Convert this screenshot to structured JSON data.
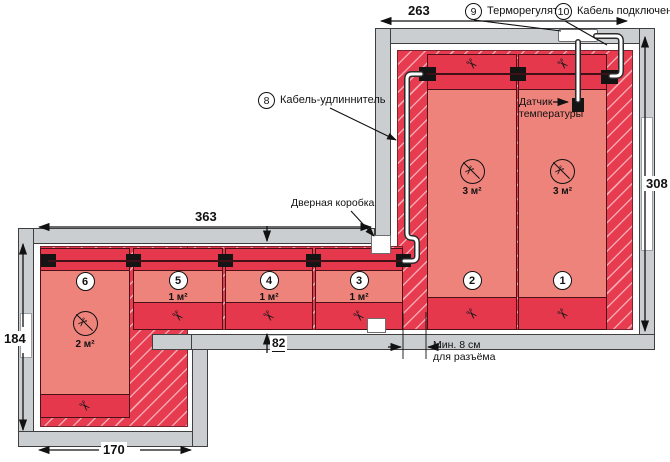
{
  "legend": {
    "thermostat": {
      "num": "9",
      "label": "Терморегулятор"
    },
    "connection_cable": {
      "num": "10",
      "label": "Кабель подключения"
    },
    "extension_cable": {
      "num": "8",
      "label": "Кабель-удлиннитель"
    },
    "sensor": {
      "line1": "Датчик",
      "line2": "температуры"
    },
    "door_frame": {
      "label": "Дверная коробка"
    },
    "min_gap": {
      "line1": "Мин. 8 см",
      "line2": "для разъёма"
    }
  },
  "dimensions": {
    "room_width": "263",
    "room_height": "308",
    "hall_width": "363",
    "hall_left_height": "184",
    "hall_bottom_width": "170",
    "doorway_width": "82"
  },
  "mats": [
    {
      "num": "1",
      "area": "3 м²",
      "no_cut": true
    },
    {
      "num": "2",
      "area": "3 м²",
      "no_cut": true
    },
    {
      "num": "3",
      "area": "1 м²",
      "no_cut": false
    },
    {
      "num": "4",
      "area": "1 м²",
      "no_cut": false
    },
    {
      "num": "5",
      "area": "1 м²",
      "no_cut": false
    },
    {
      "num": "6",
      "area": "2 м²",
      "no_cut": true
    }
  ],
  "icons": {
    "scissors": "✂"
  },
  "colors": {
    "floor_red": "#e73b4f",
    "mat_body": "#ee837b",
    "mat_strip": "#e6384c",
    "wall_gray": "#cbced0",
    "cable_white": "#ffffff"
  }
}
